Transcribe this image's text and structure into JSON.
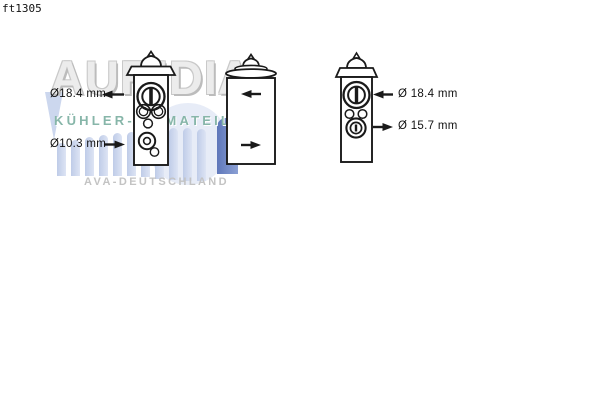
{
  "page": {
    "code": "ft1305",
    "background": "#ffffff",
    "line_color": "#1a1a1a"
  },
  "watermark": {
    "brand": "AURIDIA",
    "tagline": "KÜHLER-KLIMATEILE",
    "footer": "AVA-DEUTSCHLAND",
    "brand_color": "#cccccc",
    "tagline_color": "#87b6a9",
    "bar_light_color": "#c9d4ec",
    "bar_dark_color": "#6b82c2"
  },
  "diagram": {
    "subject": "expansion-valve technical drawing, three views",
    "front_view": {
      "top_label": {
        "text": "Ø18.4 mm",
        "arrow_direction": "left"
      },
      "bottom_label": {
        "text": "Ø10.3 mm",
        "arrow_direction": "right"
      }
    },
    "side_view": {
      "top_arrow_direction": "left",
      "bottom_arrow_direction": "right"
    },
    "port_view": {
      "top_label": {
        "text": "Ø 18.4 mm",
        "arrow_direction": "left"
      },
      "bottom_label": {
        "text": "Ø 15.7 mm",
        "arrow_direction": "right"
      }
    }
  }
}
